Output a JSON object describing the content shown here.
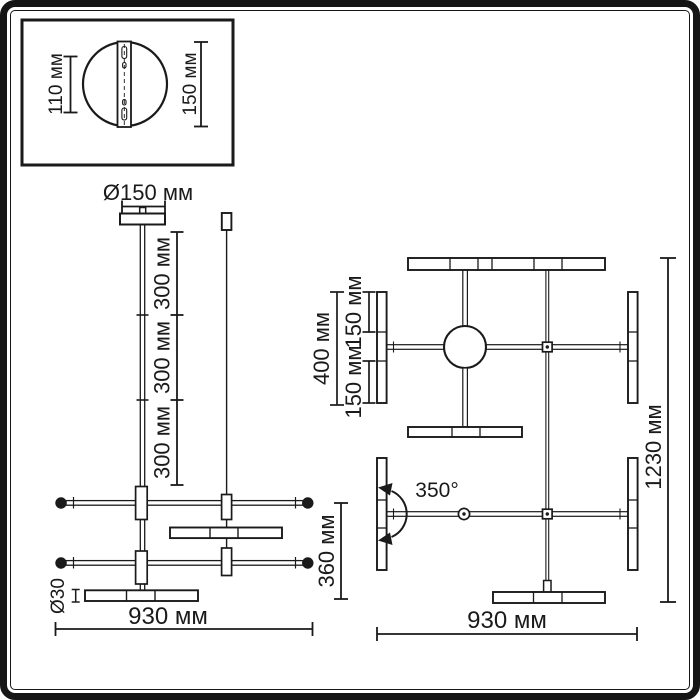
{
  "colors": {
    "line": "#1a1a1a",
    "background": "#ffffff"
  },
  "inset_detail": {
    "height_dim": "110 мм",
    "width_dim": "150 мм"
  },
  "side_view": {
    "canopy_diameter": "Ø150 мм",
    "rod_segments": [
      "300 мм",
      "300 мм",
      "300 мм"
    ],
    "tube_diameter": "Ø30",
    "body_height": "360 мм",
    "total_width": "930 мм"
  },
  "top_view": {
    "bar_length": "400 мм",
    "bar_half_upper": "150 мм",
    "bar_half_lower": "150 мм",
    "rotation_angle": "350°",
    "total_length": "1230 мм",
    "total_width": "930 мм"
  }
}
